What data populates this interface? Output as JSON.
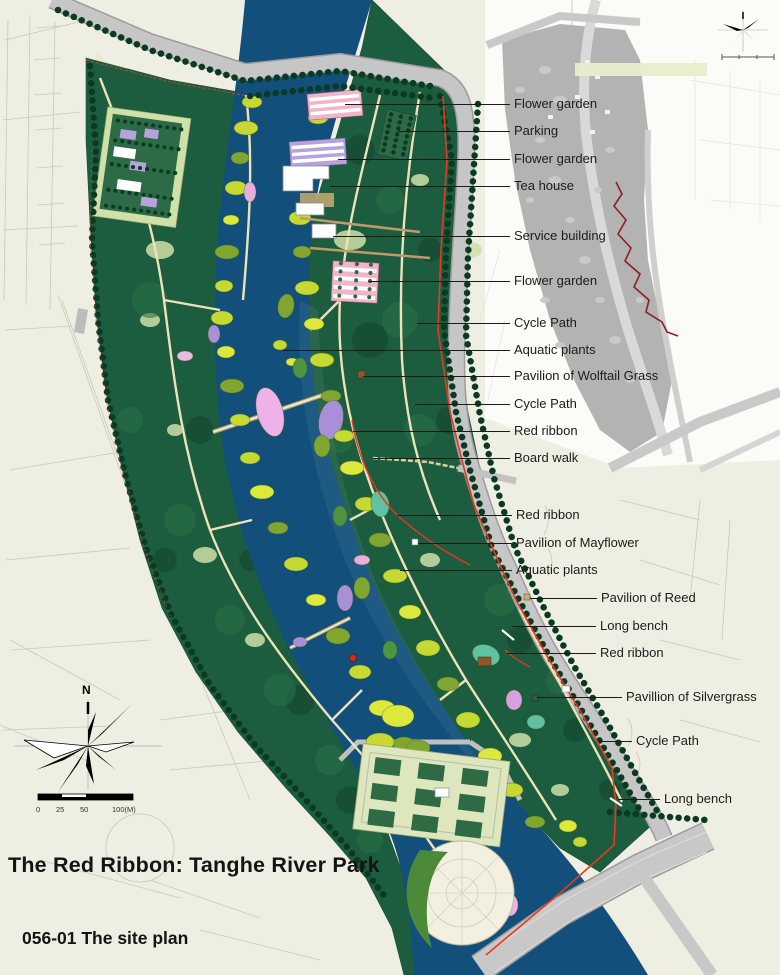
{
  "page": {
    "title": "The Red Ribbon: Tanghe River Park",
    "caption": "056-01 The site plan"
  },
  "compass": {
    "north_label": "N"
  },
  "scale_bar": {
    "ticks": [
      "0",
      "25",
      "50",
      "100(M)"
    ]
  },
  "legend_colors": {
    "background": "#eeeee3",
    "river": "#12507b",
    "park_green": "#1d5d3f",
    "road_gray": "#c6c6c6",
    "red_ribbon": "#e8391c",
    "inset_ribbon": "#8c1f20",
    "label_text": "#1c1c1c"
  },
  "labels": [
    {
      "text": "Flower garden",
      "tx": 514,
      "ty": 96,
      "lx": 345,
      "ly": 104
    },
    {
      "text": "Parking",
      "tx": 514,
      "ty": 123,
      "lx": 398,
      "ly": 131
    },
    {
      "text": "Flower garden",
      "tx": 514,
      "ty": 151,
      "lx": 338,
      "ly": 159
    },
    {
      "text": "Tea house",
      "tx": 514,
      "ty": 178,
      "lx": 330,
      "ly": 186
    },
    {
      "text": "Service building",
      "tx": 514,
      "ty": 228,
      "lx": 333,
      "ly": 236
    },
    {
      "text": "Flower garden",
      "tx": 514,
      "ty": 273,
      "lx": 368,
      "ly": 281
    },
    {
      "text": "Cycle Path",
      "tx": 514,
      "ty": 315,
      "lx": 417,
      "ly": 323
    },
    {
      "text": "Aquatic plants",
      "tx": 514,
      "ty": 342,
      "lx": 283,
      "ly": 350
    },
    {
      "text": "Pavilion of Wolftail Grass",
      "tx": 514,
      "ty": 368,
      "lx": 363,
      "ly": 376
    },
    {
      "text": "Cycle Path",
      "tx": 514,
      "ty": 396,
      "lx": 415,
      "ly": 404
    },
    {
      "text": "Red ribbon",
      "tx": 514,
      "ty": 423,
      "lx": 353,
      "ly": 431
    },
    {
      "text": "Board walk",
      "tx": 514,
      "ty": 450,
      "lx": 373,
      "ly": 458
    },
    {
      "text": "Red ribbon",
      "tx": 516,
      "ty": 507,
      "lx": 397,
      "ly": 515
    },
    {
      "text": "Pavilion of Mayflower",
      "tx": 516,
      "ty": 535,
      "lx": 418,
      "ly": 543
    },
    {
      "text": "Aquatic plants",
      "tx": 516,
      "ty": 562,
      "lx": 400,
      "ly": 570
    },
    {
      "text": "Pavilion of Reed",
      "tx": 601,
      "ty": 590,
      "lx": 530,
      "ly": 598
    },
    {
      "text": "Long bench",
      "tx": 600,
      "ty": 618,
      "lx": 512,
      "ly": 626
    },
    {
      "text": "Red ribbon",
      "tx": 600,
      "ty": 645,
      "lx": 507,
      "ly": 653
    },
    {
      "text": "Pavillion of Silvergrass",
      "tx": 626,
      "ty": 689,
      "lx": 537,
      "ly": 697
    },
    {
      "text": "Cycle Path",
      "tx": 636,
      "ty": 733,
      "lx": 598,
      "ly": 741
    },
    {
      "text": "Long bench",
      "tx": 664,
      "ty": 791,
      "lx": 618,
      "ly": 799
    }
  ]
}
